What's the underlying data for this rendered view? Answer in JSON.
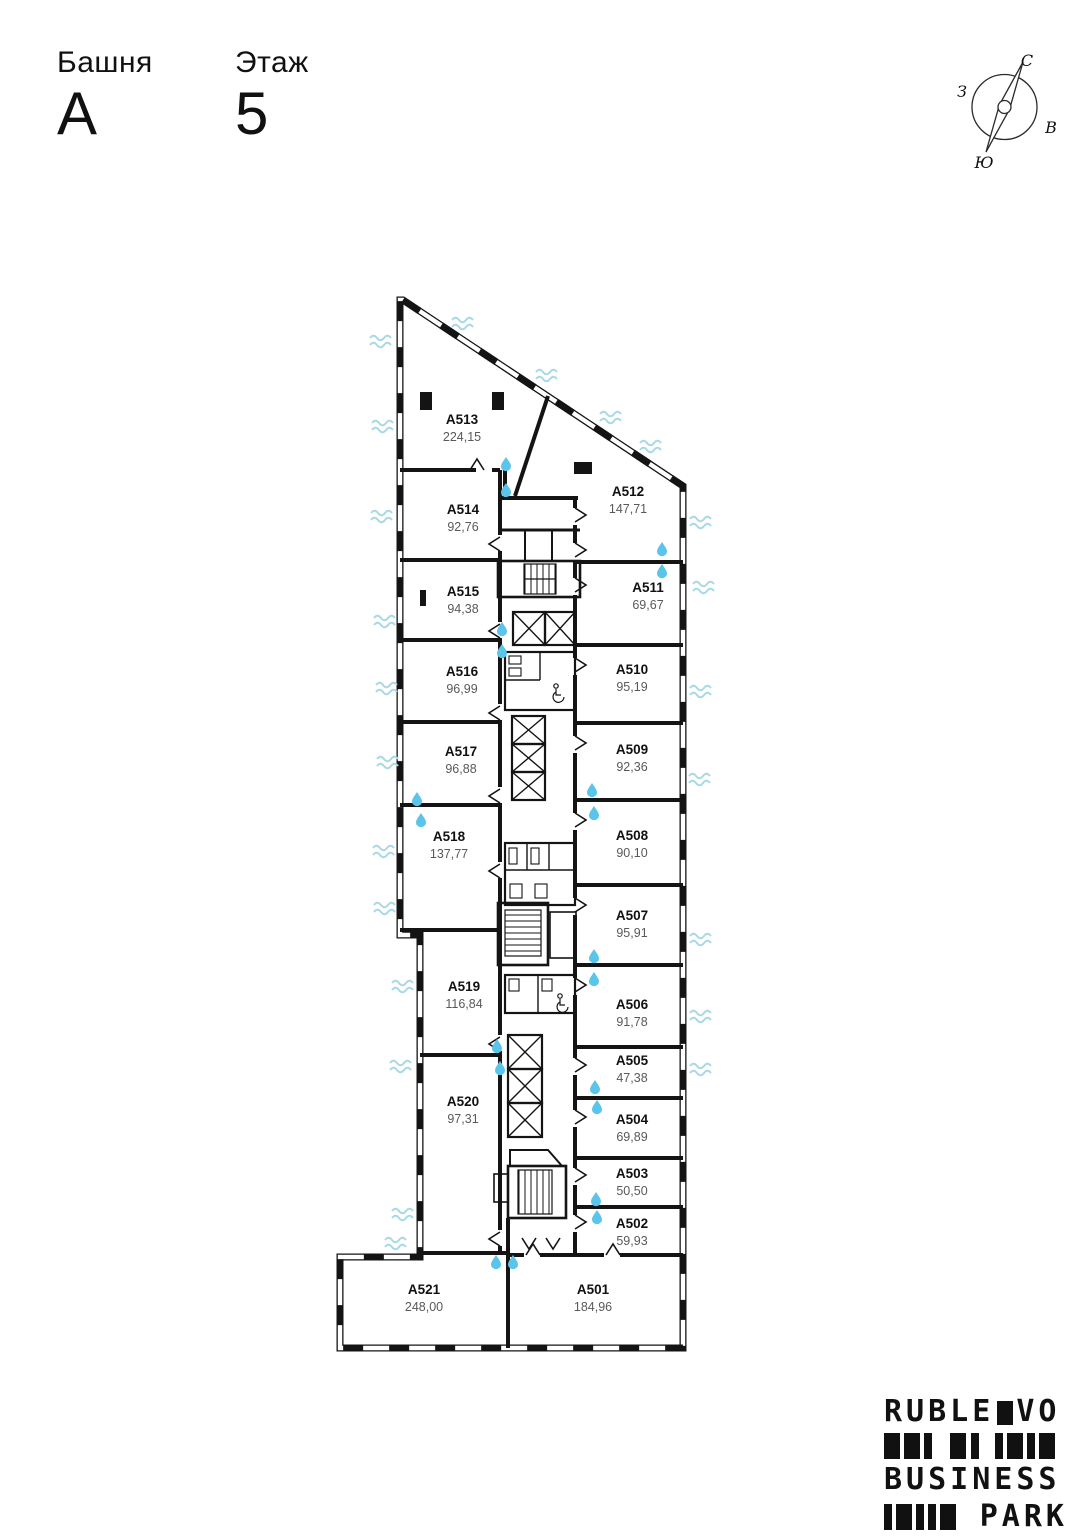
{
  "header": {
    "tower_label": "Башня",
    "tower_value": "А",
    "floor_label": "Этаж",
    "floor_value": "5"
  },
  "compass": {
    "north": "С",
    "south": "Ю",
    "west": "З",
    "east": "В"
  },
  "plan": {
    "rooms": [
      {
        "id": "A501",
        "area": "184,96"
      },
      {
        "id": "A502",
        "area": "59,93"
      },
      {
        "id": "A503",
        "area": "50,50"
      },
      {
        "id": "A504",
        "area": "69,89"
      },
      {
        "id": "A505",
        "area": "47,38"
      },
      {
        "id": "A506",
        "area": "91,78"
      },
      {
        "id": "A507",
        "area": "95,91"
      },
      {
        "id": "A508",
        "area": "90,10"
      },
      {
        "id": "A509",
        "area": "92,36"
      },
      {
        "id": "A510",
        "area": "95,19"
      },
      {
        "id": "A511",
        "area": "69,67"
      },
      {
        "id": "A512",
        "area": "147,71"
      },
      {
        "id": "A513",
        "area": "224,15"
      },
      {
        "id": "A514",
        "area": "92,76"
      },
      {
        "id": "A515",
        "area": "94,38"
      },
      {
        "id": "A516",
        "area": "96,99"
      },
      {
        "id": "A517",
        "area": "96,88"
      },
      {
        "id": "A518",
        "area": "137,77"
      },
      {
        "id": "A519",
        "area": "116,84"
      },
      {
        "id": "A520",
        "area": "97,31"
      },
      {
        "id": "A521",
        "area": "248,00"
      }
    ]
  },
  "logo": {
    "line1_left": "RUBLE",
    "line1_right": "VO",
    "line2": "BUSINESS",
    "line3": "PARK"
  },
  "colors": {
    "wall": "#141414",
    "area_text": "#58595b",
    "water_drop": "#5bc4ea",
    "vent_wave": "#a9d9e6"
  }
}
